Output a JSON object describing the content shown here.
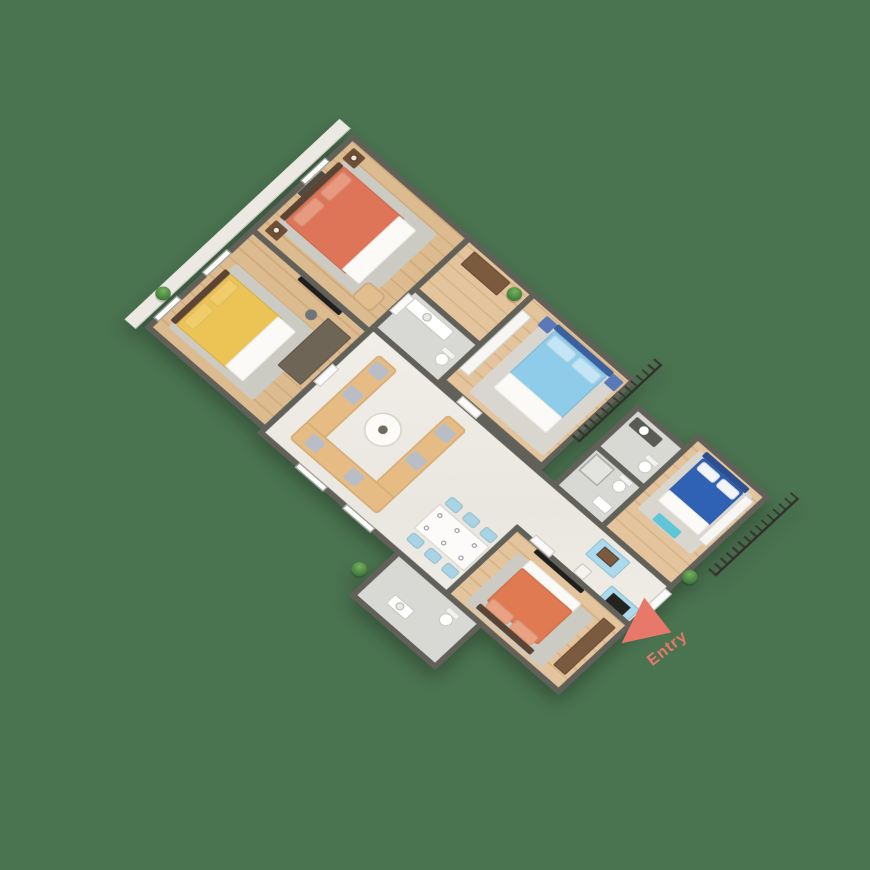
{
  "scene": {
    "description": "3D isometric rendered floor plan of a 4-bedroom apartment on a green background",
    "background_color": "#4a7350",
    "watermark_text": "LIVING.COM",
    "entry": {
      "label": "Entry",
      "arrow_color": "#e8796a"
    }
  },
  "palette": {
    "wall": "#61615a",
    "wood_floor": "#dcba8e",
    "marble_floor": "#f0ede7",
    "tile_floor": "#d8d9d4",
    "bed1_coral": "#df7558",
    "bed2_yellow": "#ecc355",
    "bed3_light_blue": "#8fccea",
    "bed4_navy": "#2f62b4",
    "bed5_orange": "#df7a52",
    "sofa_tan": "#e6bc84",
    "dining_chair_blue": "#a9d4e6",
    "kitchen_cyan": "#abdaee",
    "railing_dark": "#3a3a33",
    "plant_green": "#4f8a44"
  },
  "rooms": [
    {
      "id": "bedroom-1",
      "floor": "wood",
      "furniture": [
        "coral-double-bed",
        "wall-art",
        "two-nightstands-with-lamps",
        "armchair",
        "rug"
      ]
    },
    {
      "id": "bedroom-2",
      "floor": "wood",
      "furniture": [
        "yellow-double-bed",
        "dark-wardrobe",
        "wall-tv",
        "stool",
        "rug"
      ]
    },
    {
      "id": "foyer-dressing",
      "floor": "wood",
      "furniture": [
        "brown-dresser",
        "potted-plant"
      ]
    },
    {
      "id": "bathroom-1",
      "floor": "tile",
      "furniture": [
        "vanity-sink",
        "toilet"
      ]
    },
    {
      "id": "bedroom-3",
      "floor": "wood",
      "furniture": [
        "light-blue-double-bed",
        "white-wardrobe",
        "two-nightstands"
      ]
    },
    {
      "id": "bathroom-2",
      "floor": "tile",
      "furniture": [
        "counter-sink",
        "toilet"
      ]
    },
    {
      "id": "bathroom-3",
      "floor": "tile",
      "furniture": [
        "shower",
        "toilet",
        "sink"
      ]
    },
    {
      "id": "bedroom-4",
      "floor": "wood",
      "furniture": [
        "navy-double-bed",
        "white-wardrobe",
        "cyan-bench"
      ]
    },
    {
      "id": "living-dining-kitchen",
      "floor": "marble",
      "furniture": [
        "u-shaped-tan-sofa-set",
        "round-coffee-table",
        "dining-table-six-blue-chairs",
        "cyan-kitchen-island-with-sink",
        "cyan-cooktop-counter",
        "stool"
      ]
    },
    {
      "id": "bedroom-5",
      "floor": "wood",
      "furniture": [
        "orange-double-bed",
        "brown-wardrobe",
        "wall-tv",
        "rug"
      ]
    },
    {
      "id": "bathroom-4",
      "floor": "tile",
      "furniture": [
        "toilet",
        "sink-counter"
      ]
    }
  ],
  "exterior": [
    "balcony-railing-segment-a",
    "balcony-railing-segment-b",
    "side-walkway-ledge",
    "potted-plants"
  ]
}
